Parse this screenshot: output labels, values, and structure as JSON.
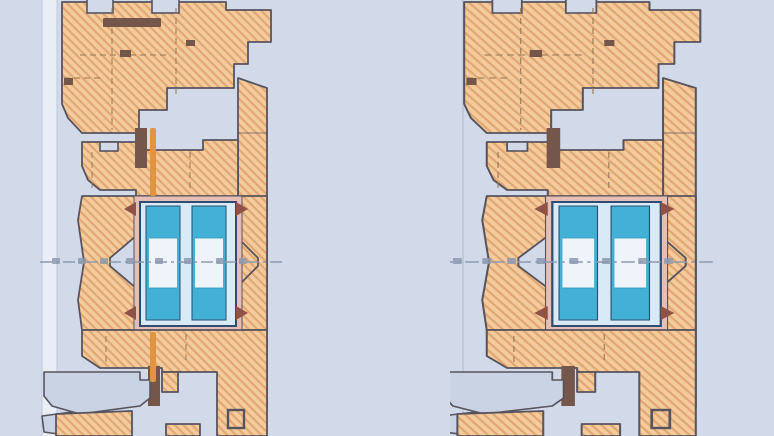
{
  "page": {
    "description": "Catalog detail figure: two vertical cross-section drawings of timber window profiles (head frame, sash, insulated double glazing, sill) on a pale blue background. No text labels are legible in the image.",
    "figure_count": 2
  },
  "colors": {
    "bg": "#d2daea",
    "band": "#e9edf6",
    "wood": "#f4cb9d",
    "woodHatch": "#e2a873",
    "outline": "#57545e",
    "hidden": "#9b7a59",
    "seal": "#75564a",
    "gasket": "#8e5247",
    "pink": "#e6beb5",
    "navy": "#2e4d72",
    "glassLight": "#d8eaf6",
    "glassPane": "#eef4fa",
    "cyan": "#43b1d5",
    "cyanDark": "#2d98c0",
    "alloy": "#c9d3e3",
    "centerline": "#8d99af",
    "orange": "#e39440",
    "ext": "#bac4d6"
  },
  "sections": [
    {
      "id": "left",
      "name": "window-section-left",
      "description": "Vertical section through timber window, variant with hardware axis line (orange) and dark seal strip; dimension extension band at left, dash-dot centerline with illegible dimension figures at mid-height.",
      "has_hardware_axis": true
    },
    {
      "id": "right",
      "name": "window-section-right",
      "description": "Vertical section through timber window, wider variant without hardware axis; dash-dot centerline with illegible dimension figures at mid-height.",
      "has_hardware_axis": false
    }
  ]
}
